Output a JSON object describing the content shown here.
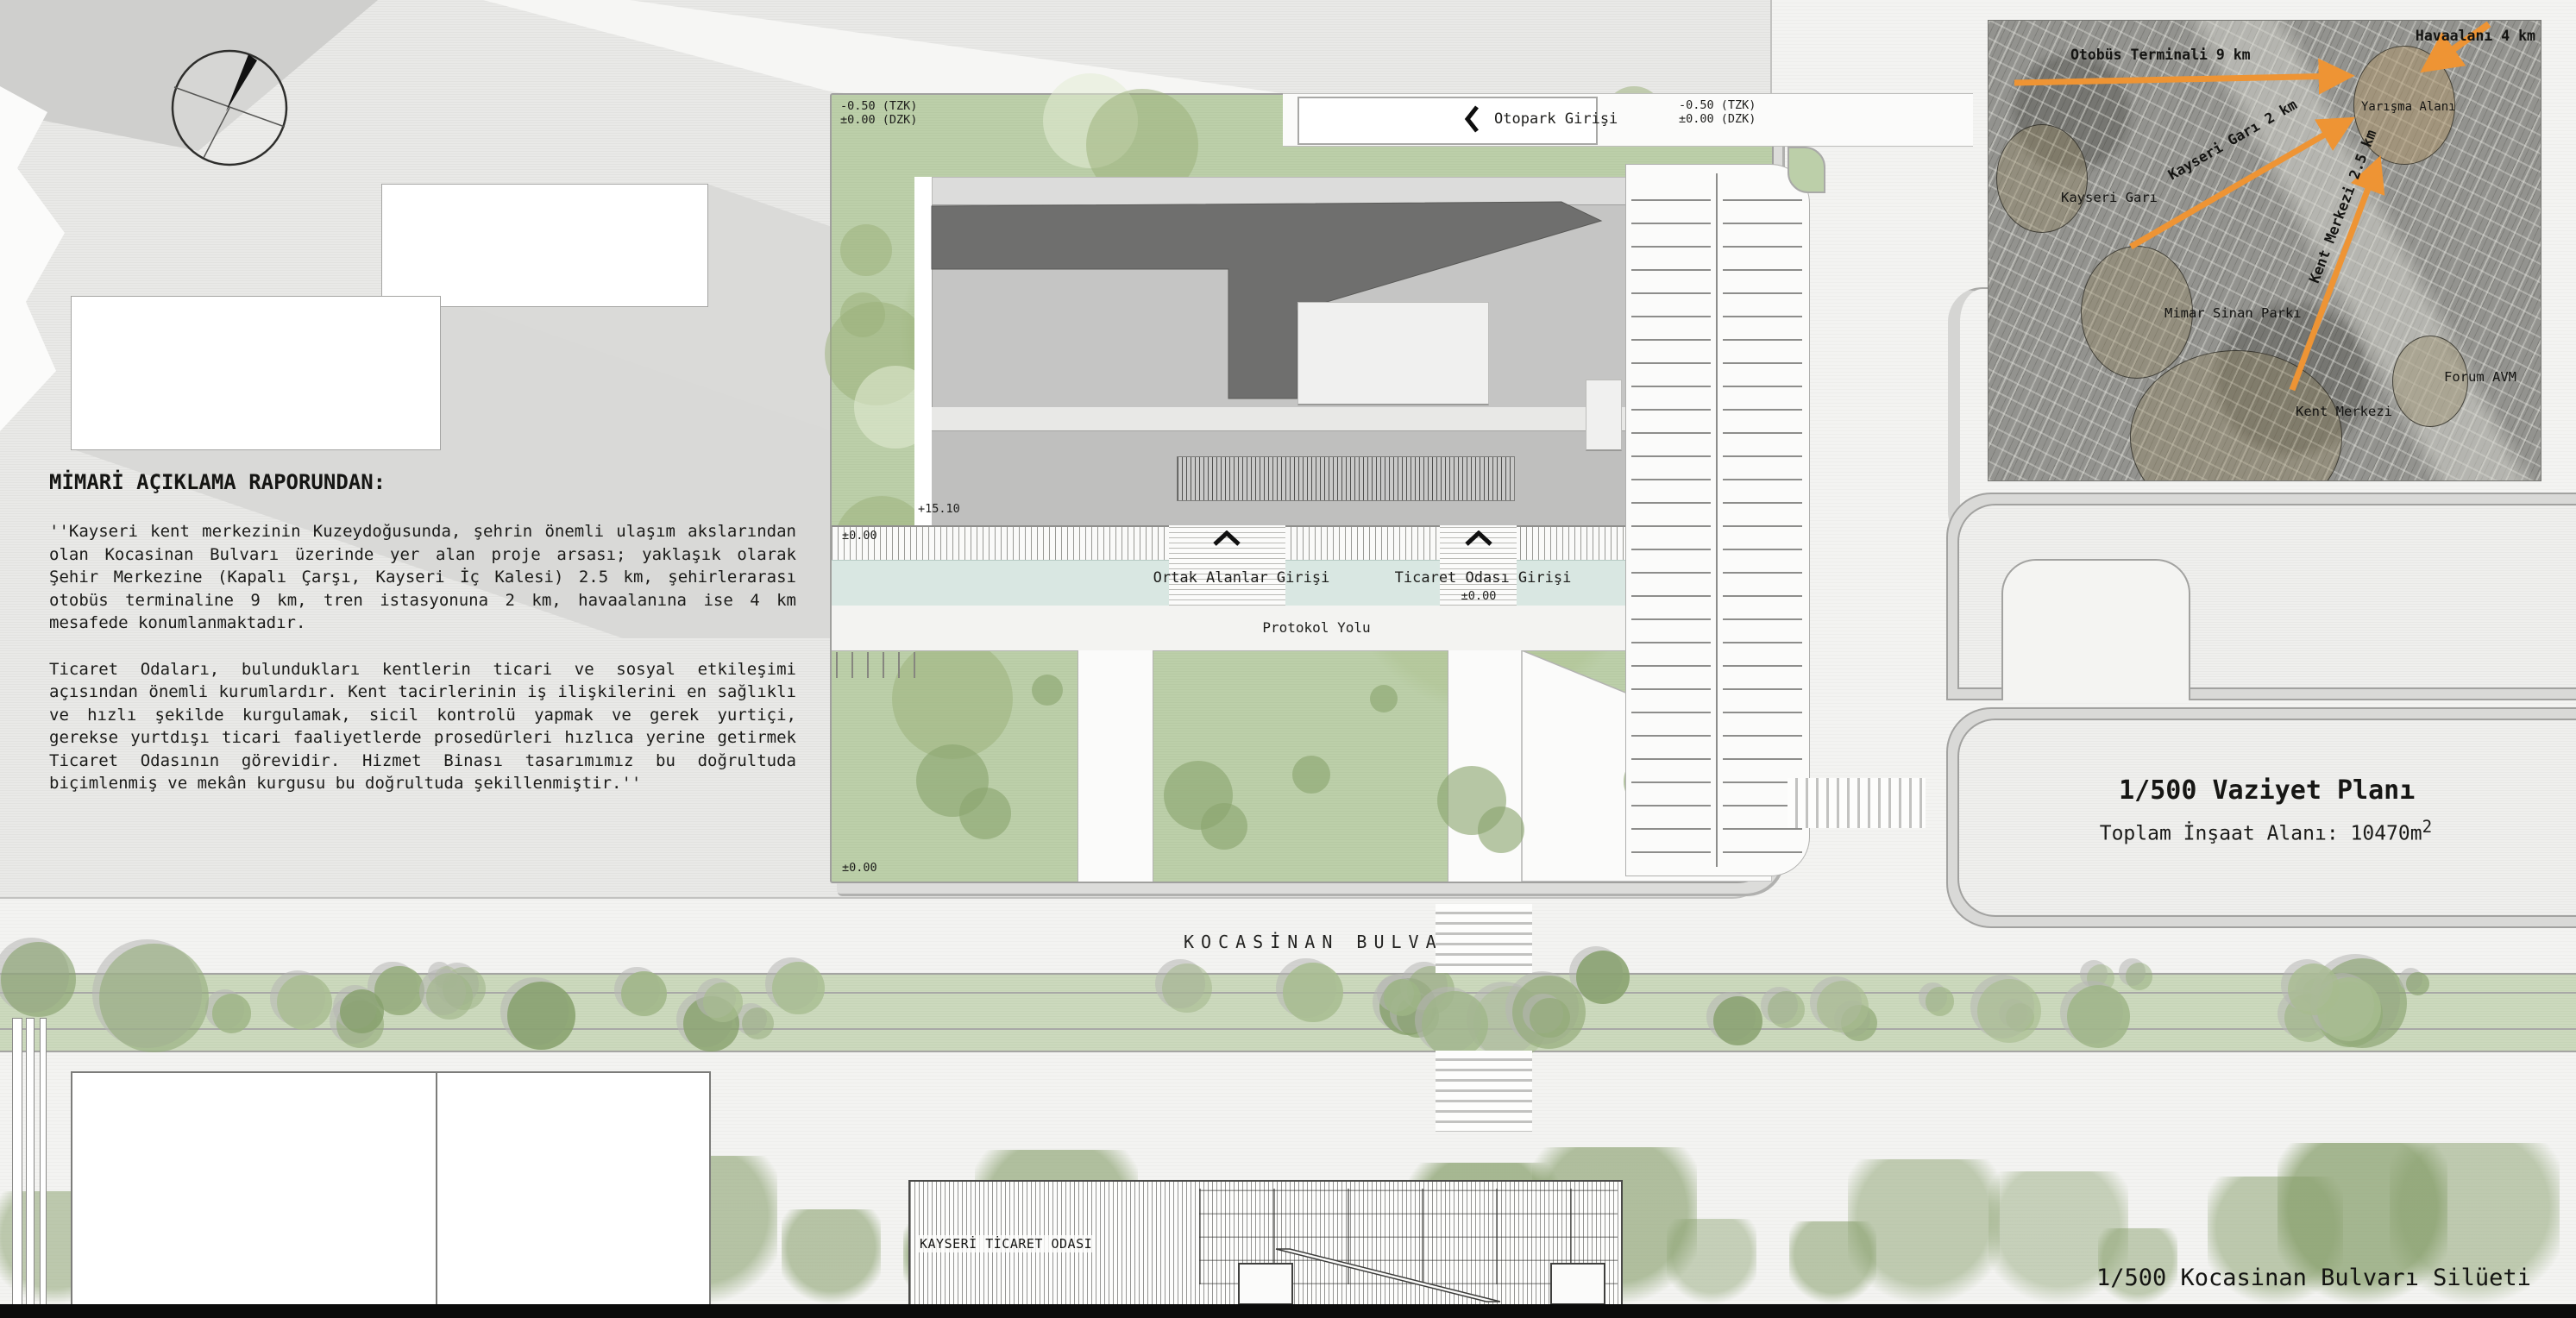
{
  "report": {
    "title": "MİMARİ AÇIKLAMA RAPORUNDAN:",
    "paragraph1": "''Kayseri kent merkezinin Kuzeydoğusunda, şehrin önemli ulaşım akslarından olan Kocasinan Bulvarı üzerinde yer alan proje arsası; yaklaşık olarak Şehir Merkezine (Kapalı Çarşı, Kayseri İç Kalesi) 2.5 km, şehirlerarası otobüs terminaline 9 km, tren istasyonuna 2 km, havaalanına ise 4 km mesafede konumlanmaktadır.",
    "paragraph2": "Ticaret Odaları, bulundukları kentlerin ticari ve sosyal etkileşimi açısından önemli kurumlardır. Kent tacirlerinin iş ilişkilerini en sağlıklı ve hızlı şekilde kurgulamak, sicil kontrolü yapmak ve gerek yurtiçi, gerekse yurtdışı ticari faaliyetlerde prosedürleri hızlıca yerine getirmek Ticaret Odasının görevidir. Hizmet Binası tasarımımız bu doğrultuda biçimlenmiş ve mekân kurgusu bu doğrultuda şekillenmiştir.''"
  },
  "site_plan": {
    "levels": {
      "tzk": "-0.50 (TZK)",
      "dzk": "±0.00 (DZK)",
      "zero": "±0.00",
      "roof": "+15.10"
    },
    "labels": {
      "otopark_entry": "Otopark Girişi",
      "common_entry": "Ortak Alanlar Girişi",
      "chamber_entry": "Ticaret Odası Girişi",
      "protocol_road": "Protokol Yolu"
    }
  },
  "location_map": {
    "arrow_labels": {
      "bus_terminal": "Otobüs Terminali 9 km",
      "airport": "Havaalanı 4 km",
      "train_station": "Kayseri Garı 2 km",
      "city_center": "Kent Merkezi 2.5 km"
    },
    "markers": {
      "site": "Yarışma Alanı",
      "station": "Kayseri Garı",
      "park": "Mimar Sinan Parkı",
      "center": "Kent Merkezi",
      "mall": "Forum AVM"
    },
    "accent_color": "#ee9434"
  },
  "captions": {
    "plan_title": "1/500 Vaziyet Planı",
    "plan_area_label": "Toplam İnşaat Alanı: 10470m",
    "plan_area_sup": "2",
    "silhouette_title": "1/500 Kocasinan Bulvarı Silüeti",
    "boulevard": "KOCASİNAN BULVARI",
    "building_name": "KAYSERİ TİCARET ODASI"
  }
}
